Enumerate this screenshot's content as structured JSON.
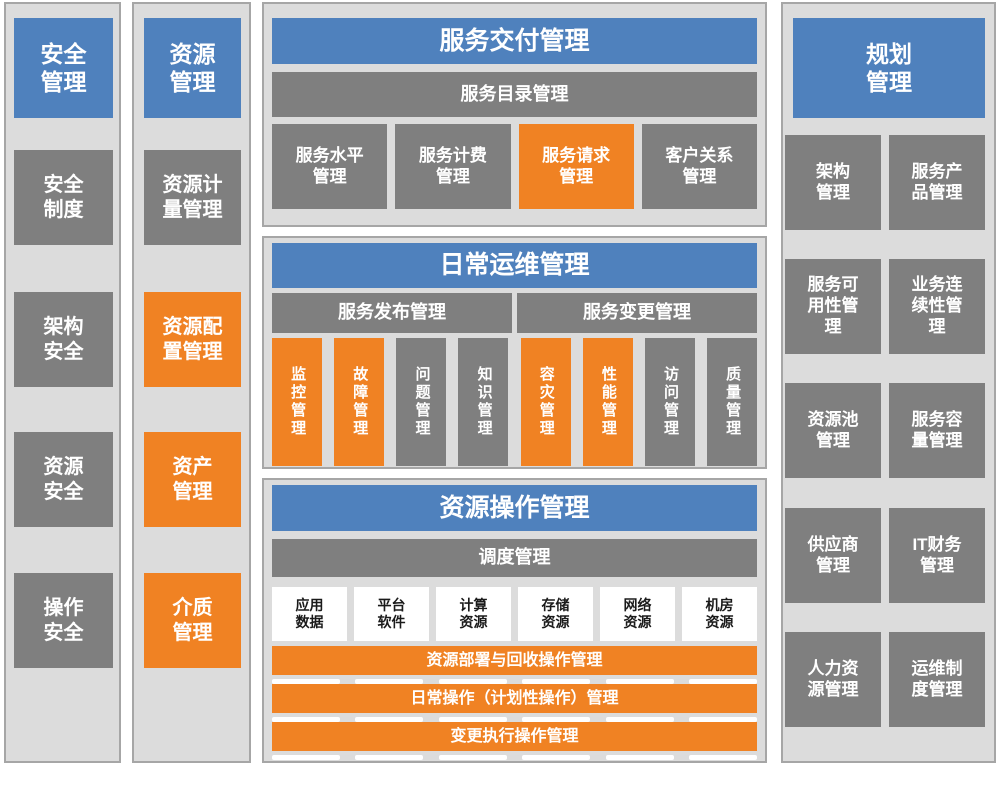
{
  "colors": {
    "blue": "#4F81BD",
    "orange": "#F08223",
    "gray": "#7F7F7F",
    "white": "#FFFFFF",
    "panel_bg": "#DCDCDC",
    "panel_border": "#A6A6A6",
    "dark_text": "#1A1A1A"
  },
  "security": {
    "title": "安全\n管理",
    "items": [
      {
        "label": "安全\n制度",
        "color": "gray"
      },
      {
        "label": "架构\n安全",
        "color": "gray"
      },
      {
        "label": "资源\n安全",
        "color": "gray"
      },
      {
        "label": "操作\n安全",
        "color": "gray"
      }
    ]
  },
  "resource": {
    "title": "资源\n管理",
    "items": [
      {
        "label": "资源计\n量管理",
        "color": "gray"
      },
      {
        "label": "资源配\n置管理",
        "color": "orange"
      },
      {
        "label": "资产\n管理",
        "color": "orange"
      },
      {
        "label": "介质\n管理",
        "color": "orange"
      }
    ]
  },
  "service_delivery": {
    "title": "服务交付管理",
    "catalog_bar": "服务目录管理",
    "items": [
      {
        "label": "服务水平\n管理",
        "color": "gray"
      },
      {
        "label": "服务计费\n管理",
        "color": "gray"
      },
      {
        "label": "服务请求\n管理",
        "color": "orange"
      },
      {
        "label": "客户关系\n管理",
        "color": "gray"
      }
    ]
  },
  "daily_ops": {
    "title": "日常运维管理",
    "release_bar": "服务发布管理",
    "change_bar": "服务变更管理",
    "items": [
      {
        "label": "监控管理",
        "color": "orange"
      },
      {
        "label": "故障管理",
        "color": "orange"
      },
      {
        "label": "问题管理",
        "color": "gray"
      },
      {
        "label": "知识管理",
        "color": "gray"
      },
      {
        "label": "容灾管理",
        "color": "orange"
      },
      {
        "label": "性能管理",
        "color": "orange"
      },
      {
        "label": "访问管理",
        "color": "gray"
      },
      {
        "label": "质量管理",
        "color": "gray"
      }
    ]
  },
  "resource_ops": {
    "title": "资源操作管理",
    "schedule_bar": "调度管理",
    "resources": [
      {
        "label": "应用\n数据"
      },
      {
        "label": "平台\n软件"
      },
      {
        "label": "计算\n资源"
      },
      {
        "label": "存储\n资源"
      },
      {
        "label": "网络\n资源"
      },
      {
        "label": "机房\n资源"
      }
    ],
    "bars": [
      {
        "label": "资源部署与回收操作管理"
      },
      {
        "label": "日常操作（计划性操作）管理"
      },
      {
        "label": "变更执行操作管理"
      }
    ]
  },
  "planning": {
    "title": "规划\n管理",
    "items": [
      {
        "label": "架构\n管理"
      },
      {
        "label": "服务产\n品管理"
      },
      {
        "label": "服务可\n用性管\n理"
      },
      {
        "label": "业务连\n续性管\n理"
      },
      {
        "label": "资源池\n管理"
      },
      {
        "label": "服务容\n量管理"
      },
      {
        "label": "供应商\n管理"
      },
      {
        "label": "IT财务\n管理"
      },
      {
        "label": "人力资\n源管理"
      },
      {
        "label": "运维制\n度管理"
      }
    ]
  }
}
